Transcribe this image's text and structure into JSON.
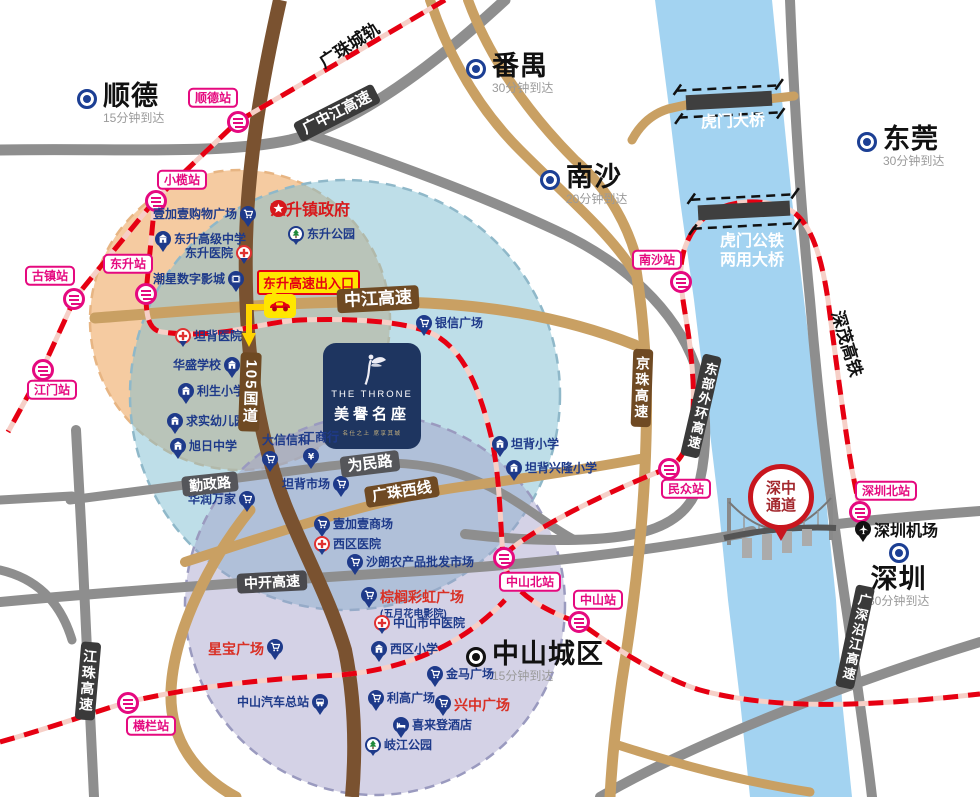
{
  "colors": {
    "rail_red": "#E60012",
    "rail_base": "#F6CFC7",
    "road_gray": "#8E8E8E",
    "road_tan": "#C9A063",
    "road_brown": "#7A5230",
    "badge_dark": "#3A3A3A",
    "badge_gray": "#55565A",
    "badge_brown": "#6F4A23",
    "river": "#A3D3F1",
    "station_pink": "#E5097F",
    "poi_navy": "#1E3A8A",
    "poi_red": "#D93025",
    "city_blue": "#1C3F94",
    "city_black": "#111111",
    "circle_orange": "rgba(240,175,110,0.65)",
    "circle_teal": "rgba(125,190,210,0.50)",
    "circle_purple": "rgba(160,155,200,0.45)",
    "exit_yellow": "#FFE600",
    "channel_red": "#C8161E"
  },
  "project": {
    "name_en": "THE THRONE",
    "name_cn": "美譽名座",
    "tagline": "名仕之上  席享其城",
    "x": 323,
    "y": 343,
    "w": 98,
    "h": 106,
    "swan_icon": "swan-logo-icon"
  },
  "government": {
    "name": "东升镇政府",
    "x": 270,
    "y": 196,
    "icon": "star-icon"
  },
  "exit": {
    "label": "东升高速出入口",
    "x": 257,
    "y": 270,
    "car_x": 264,
    "car_y": 294,
    "icon": "car-icon"
  },
  "channel": {
    "line1": "深中",
    "line2": "通道",
    "x": 748,
    "y": 464
  },
  "cities": [
    {
      "name": "顺德",
      "eta": "15分钟到达",
      "x": 77,
      "y": 82,
      "color": "#1C3F94",
      "layout": "dot-left"
    },
    {
      "name": "番禺",
      "eta": "30分钟到达",
      "x": 466,
      "y": 52,
      "color": "#1C3F94",
      "layout": "dot-left"
    },
    {
      "name": "南沙",
      "eta": "20分钟到达",
      "x": 540,
      "y": 163,
      "color": "#1C3F94",
      "layout": "dot-left"
    },
    {
      "name": "东莞",
      "eta": "30分钟到达",
      "x": 857,
      "y": 125,
      "color": "#1C3F94",
      "layout": "dot-left"
    },
    {
      "name": "深圳",
      "eta": "30分钟到达",
      "x": 868,
      "y": 543,
      "color": "#1C3F94",
      "layout": "dot-top"
    },
    {
      "name": "中山城区",
      "eta": "15分钟到达",
      "x": 466,
      "y": 640,
      "color": "#111111",
      "layout": "dot-left"
    }
  ],
  "stations": [
    {
      "name": "顺德站",
      "icon": [
        238,
        122
      ],
      "label": [
        213,
        98
      ]
    },
    {
      "name": "小榄站",
      "icon": [
        156,
        201
      ],
      "label": [
        182,
        180
      ]
    },
    {
      "name": "东升站",
      "icon": [
        146,
        294
      ],
      "label": [
        128,
        264
      ]
    },
    {
      "name": "古镇站",
      "icon": [
        74,
        299
      ],
      "label": [
        50,
        276
      ]
    },
    {
      "name": "江门站",
      "icon": [
        43,
        370
      ],
      "label": [
        52,
        390
      ]
    },
    {
      "name": "南沙站",
      "icon": [
        681,
        282
      ],
      "label": [
        657,
        260
      ]
    },
    {
      "name": "民众站",
      "icon": [
        669,
        469
      ],
      "label": [
        686,
        489
      ]
    },
    {
      "name": "中山北站",
      "icon": [
        504,
        558
      ],
      "label": [
        530,
        582
      ]
    },
    {
      "name": "中山站",
      "icon": [
        579,
        622
      ],
      "label": [
        598,
        600
      ]
    },
    {
      "name": "横栏站",
      "icon": [
        128,
        703
      ],
      "label": [
        151,
        726
      ]
    },
    {
      "name": "深圳北站",
      "icon": [
        860,
        512
      ],
      "label": [
        886,
        491
      ]
    }
  ],
  "pois": [
    {
      "name": "壹加壹购物广场",
      "icon": "cart-icon",
      "side": "right",
      "x": 153,
      "y": 206
    },
    {
      "name": "东升高级中学",
      "icon": "school-icon",
      "side": "left",
      "x": 155,
      "y": 231
    },
    {
      "name": "东升医院",
      "icon": "hospital-icon",
      "side": "right",
      "x": 185,
      "y": 245,
      "variant": "hospital"
    },
    {
      "name": "潮星数字影城",
      "icon": "film-icon",
      "side": "right",
      "x": 153,
      "y": 271
    },
    {
      "name": "东升公园",
      "icon": "tree-icon",
      "side": "left",
      "x": 288,
      "y": 226,
      "variant": "tree"
    },
    {
      "name": "坦背医院",
      "icon": "hospital-icon",
      "side": "left",
      "x": 175,
      "y": 328,
      "variant": "hospital"
    },
    {
      "name": "华盛学校",
      "icon": "school-icon",
      "side": "right",
      "x": 173,
      "y": 357
    },
    {
      "name": "利生小学",
      "icon": "school-icon",
      "side": "left",
      "x": 178,
      "y": 383
    },
    {
      "name": "求实幼儿园",
      "icon": "school-icon",
      "side": "left",
      "x": 167,
      "y": 413
    },
    {
      "name": "旭日中学",
      "icon": "school-icon",
      "side": "left",
      "x": 170,
      "y": 438
    },
    {
      "name": "银信广场",
      "icon": "cart-icon",
      "side": "left",
      "x": 416,
      "y": 315
    },
    {
      "name": "大信信和",
      "icon": "cart-icon",
      "side": "below",
      "x": 262,
      "y": 432
    },
    {
      "name": "工商行",
      "icon": "bank-icon",
      "side": "below",
      "x": 303,
      "y": 429
    },
    {
      "name": "坦背市场",
      "icon": "cart-icon",
      "side": "right",
      "x": 282,
      "y": 476
    },
    {
      "name": "华润万家",
      "icon": "cart-icon",
      "side": "right",
      "x": 188,
      "y": 491
    },
    {
      "name": "坦背小学",
      "icon": "school-icon",
      "side": "left",
      "x": 492,
      "y": 436
    },
    {
      "name": "坦背兴隆小学",
      "icon": "school-icon",
      "side": "left",
      "x": 506,
      "y": 460
    },
    {
      "name": "壹加壹商场",
      "icon": "cart-icon",
      "side": "left",
      "x": 314,
      "y": 516
    },
    {
      "name": "西区医院",
      "icon": "hospital-icon",
      "side": "left",
      "x": 314,
      "y": 536,
      "variant": "hospital"
    },
    {
      "name": "沙朗农产品批发市场",
      "icon": "cart-icon",
      "side": "left",
      "x": 347,
      "y": 554
    },
    {
      "name": "棕榈彩虹广场",
      "icon": "cart-icon",
      "side": "left",
      "x": 361,
      "y": 587,
      "label_color": "red",
      "sub": "(五月花电影院)"
    },
    {
      "name": "中山市中医院",
      "icon": "hospital-icon",
      "side": "left",
      "x": 374,
      "y": 615,
      "variant": "hospital"
    },
    {
      "name": "西区小学",
      "icon": "school-icon",
      "side": "left",
      "x": 371,
      "y": 641
    },
    {
      "name": "金马广场",
      "icon": "cart-icon",
      "side": "left",
      "x": 427,
      "y": 666
    },
    {
      "name": "利高广场",
      "icon": "cart-icon",
      "side": "left",
      "x": 368,
      "y": 690
    },
    {
      "name": "兴中广场",
      "icon": "cart-icon",
      "side": "left",
      "x": 435,
      "y": 695,
      "label_color": "red"
    },
    {
      "name": "喜来登酒店",
      "icon": "hotel-icon",
      "side": "left",
      "x": 393,
      "y": 717
    },
    {
      "name": "岐江公园",
      "icon": "tree-icon",
      "side": "left",
      "x": 365,
      "y": 737,
      "variant": "tree"
    },
    {
      "name": "星宝广场",
      "icon": "cart-icon",
      "side": "right",
      "x": 208,
      "y": 639,
      "label_color": "red"
    },
    {
      "name": "中山汽车总站",
      "icon": "bus-icon",
      "side": "right",
      "x": 237,
      "y": 694
    },
    {
      "name": "深圳机场",
      "icon": "plane-icon",
      "side": "left",
      "x": 855,
      "y": 521,
      "variant": "black",
      "label_style": "airport"
    }
  ],
  "road_badges": [
    {
      "text": "广中江高速",
      "x": 337,
      "y": 113,
      "bg": "#3A3A3A",
      "rot": -27,
      "fs": 15
    },
    {
      "text": "中江高速",
      "x": 378,
      "y": 299,
      "bg": "#6F4A23",
      "rot": -3,
      "fs": 17
    },
    {
      "text": "勤政路",
      "x": 210,
      "y": 484,
      "bg": "#55565A",
      "rot": -6,
      "fs": 14
    },
    {
      "text": "为民路",
      "x": 370,
      "y": 464,
      "bg": "#55565A",
      "rot": -7,
      "fs": 15
    },
    {
      "text": "广珠西线",
      "x": 402,
      "y": 492,
      "bg": "#6F4A23",
      "rot": -9,
      "fs": 15
    },
    {
      "text": "中开高速",
      "x": 272,
      "y": 582,
      "bg": "#4A4A4E",
      "rot": -3,
      "fs": 14
    },
    {
      "text": "105国道",
      "x": 250,
      "y": 392,
      "bg": "#6F4A23",
      "rot": 2,
      "fs": 15,
      "vertical": true
    },
    {
      "text": "江珠高速",
      "x": 88,
      "y": 681,
      "bg": "#3A3A3A",
      "rot": 5,
      "fs": 14,
      "vertical": true
    },
    {
      "text": "京珠高速",
      "x": 642,
      "y": 388,
      "bg": "#6F4A23",
      "rot": 2,
      "fs": 14,
      "vertical": true
    },
    {
      "text": "东部外环高速",
      "x": 701,
      "y": 406,
      "bg": "#3A3A3A",
      "rot": 13,
      "fs": 13,
      "vertical": true
    },
    {
      "text": "广深沿江高速",
      "x": 855,
      "y": 637,
      "bg": "#3A3A3A",
      "rot": 12,
      "fs": 13,
      "vertical": true
    }
  ],
  "plain_labels": [
    {
      "text": "广珠城轨",
      "x": 350,
      "y": 46,
      "rot": -33,
      "fs": 17,
      "color": "#111111"
    },
    {
      "text": "深茂高铁",
      "x": 846,
      "y": 344,
      "rot": 73,
      "fs": 17,
      "color": "#111111"
    },
    {
      "text": "虎门大桥",
      "x": 733,
      "y": 122,
      "rot": -2,
      "fs": 16,
      "color": "#FFFFFF"
    },
    {
      "text": "虎门公铁\n两用大桥",
      "x": 752,
      "y": 251,
      "rot": 0,
      "fs": 16,
      "color": "#FFFFFF"
    }
  ]
}
